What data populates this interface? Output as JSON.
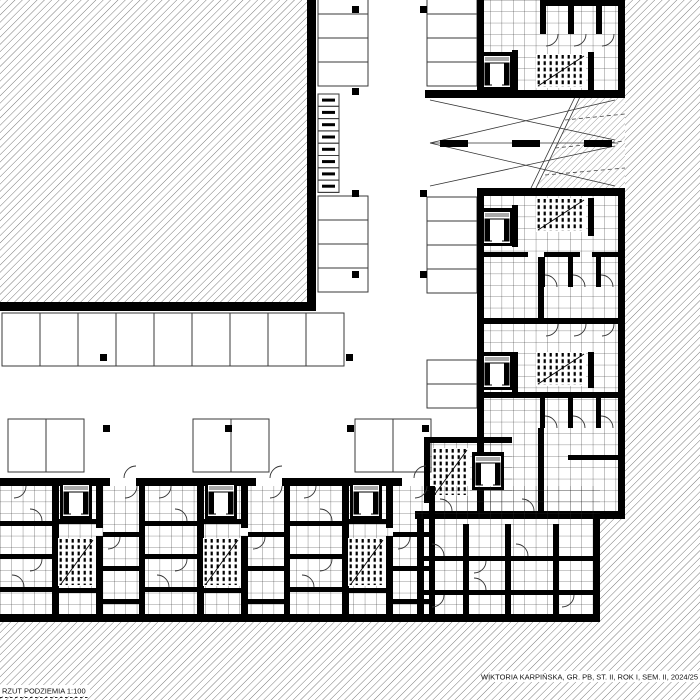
{
  "titleblock": {
    "title": "RZUT PODZIEMIA 1:100",
    "credits": "WIKTORIA KARPIŃSKA, GR. PB, ST. II, ROK I, SEM. II, 2024/25"
  },
  "palette": {
    "ink": "#000000",
    "paper": "#ffffff",
    "hatch_line": "#6e6e6e",
    "tile_line": "#2b2b2b"
  }
}
